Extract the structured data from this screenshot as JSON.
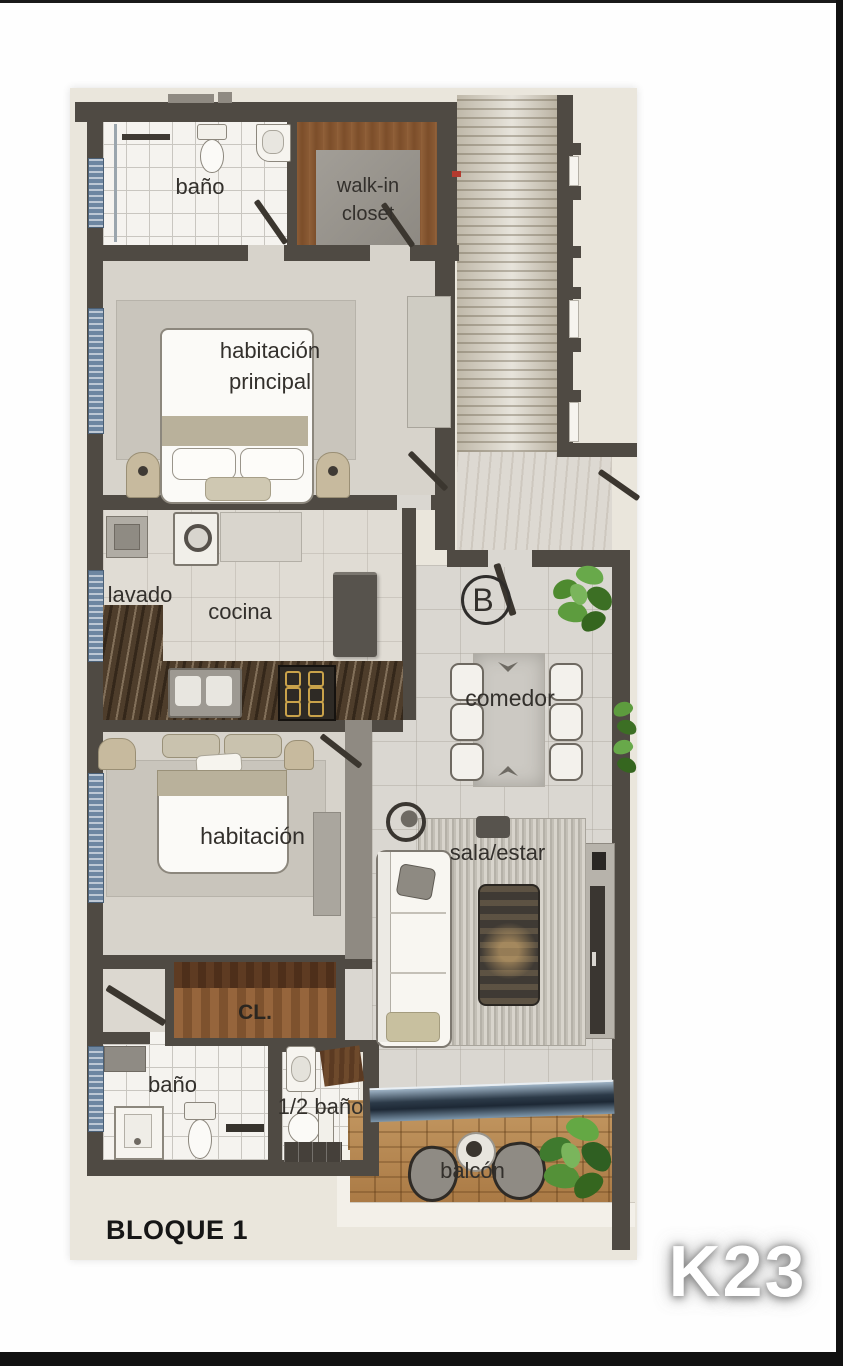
{
  "page": {
    "block_label": "BLOQUE 1",
    "unit_code": "K23"
  },
  "labels": {
    "bathroom_top": "baño",
    "walk_in_closet": "walk-in closet",
    "master_bedroom": "habitación principal",
    "laundry": "lavado",
    "kitchen": "cocina",
    "entry_point": "B",
    "dining": "comedor",
    "bedroom": "habitación",
    "living": "sala/estar",
    "closet": "CL.",
    "bathroom_bottom": "baño",
    "half_bathroom": "1/2 baño",
    "balcony": "balcón"
  },
  "colors": {
    "sheet_bg": "#eae6dc",
    "wall_dark": "#4f4a43",
    "wall_light": "#8f8a82",
    "wood_closet": "#8a5c38",
    "window_glass": "#6d86a1",
    "marble_counter": "#4e3d2b",
    "deck_wood": "#b5854e",
    "plant_green": "#4e8a2f",
    "rug": "#c9c5bc",
    "label_text": "#33302c",
    "unit_code_text": "#ffffff"
  }
}
